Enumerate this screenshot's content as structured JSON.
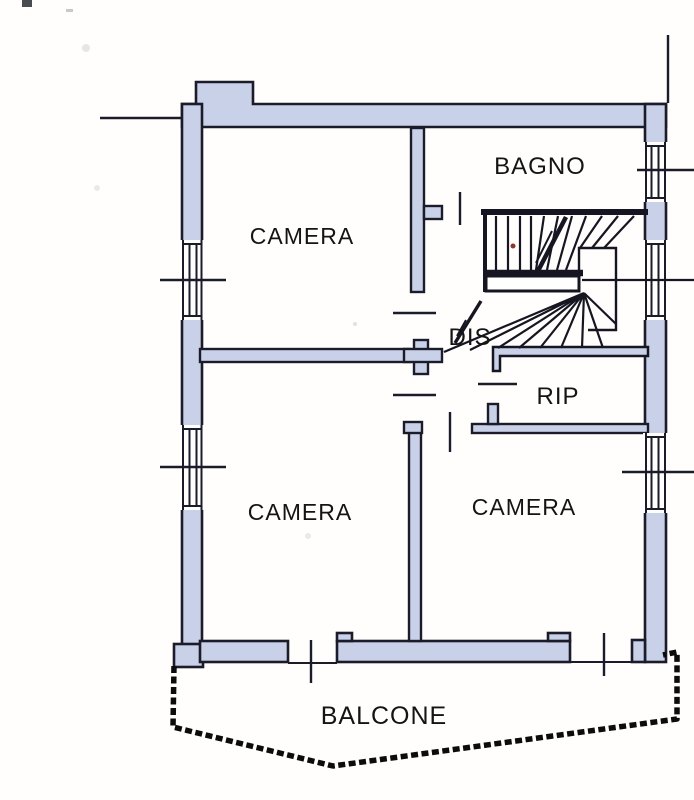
{
  "document": {
    "type": "floor-plan-scan",
    "language": "it"
  },
  "rooms": [
    {
      "id": "camera-top-left",
      "label": "CAMERA"
    },
    {
      "id": "bagno",
      "label": "BAGNO"
    },
    {
      "id": "dis",
      "label": "DIS"
    },
    {
      "id": "rip",
      "label": "RIP"
    },
    {
      "id": "camera-bottom-left",
      "label": "CAMERA"
    },
    {
      "id": "camera-bottom-right",
      "label": "CAMERA"
    },
    {
      "id": "balcone",
      "label": "BALCONE"
    }
  ],
  "features": {
    "staircase": "winder-stair-with-mid-landing",
    "windows_left_wall": 2,
    "windows_right_wall": 3,
    "balcony_doors": 2
  },
  "colors": {
    "wall_fill": "#c9d1e8",
    "outline": "#1b1b2a",
    "balcony_outline": "#0c0c0c",
    "background": "#fffefc",
    "stain_red": "#7c1f1a"
  }
}
